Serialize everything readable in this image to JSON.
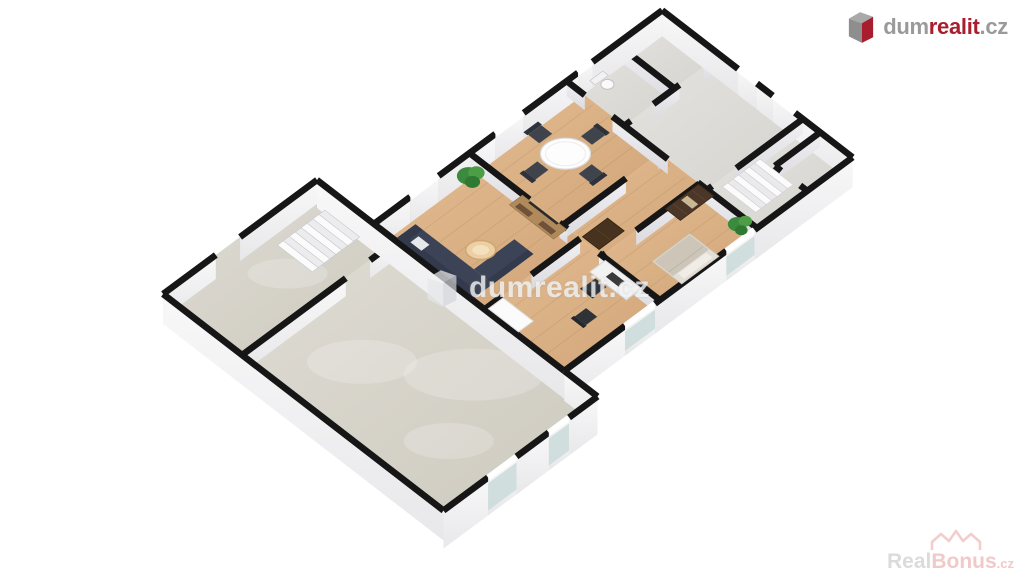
{
  "logo": {
    "dum": "dum",
    "realit": "realit",
    "cz": ".cz"
  },
  "watermark_center": {
    "text": "dumrealit.cz"
  },
  "watermark_bottom": {
    "real": "Real",
    "bonus": "Bonus",
    "cz": ".cz"
  },
  "colors": {
    "background": "#ffffff",
    "wall_line": "#161616",
    "floor_wood": "#d9af83",
    "floor_concrete": "#d5d2c9",
    "floor_tile": "#dedcd7",
    "sofa_navy": "#3c4356",
    "chair_dark": "#3e434c",
    "plant_green": "#3c8a3e",
    "wardrobe_brown": "#4b3627",
    "tv_unit_wood": "#b18a5b",
    "glass": "#ccdcdc",
    "logo_gray": "#9a9a9a",
    "logo_red": "#a81e2e",
    "watermark_light": "#f0f2f4",
    "realbonus_gray": "#d9d9d9",
    "realbonus_pink": "#f1c5c5"
  },
  "floorplan": {
    "type": "3d-isometric-floor-plan",
    "rooms": [
      {
        "name": "garage",
        "floor": "concrete",
        "furniture": []
      },
      {
        "name": "staircase-room",
        "floor": "concrete",
        "furniture": [
          "staircase"
        ]
      },
      {
        "name": "living-room",
        "floor": "wood",
        "furniture": [
          "corner-sofa",
          "coffee-table",
          "tv-wall-unit",
          "plant"
        ]
      },
      {
        "name": "dining-room",
        "floor": "wood",
        "furniture": [
          "round-table",
          "four-chairs"
        ]
      },
      {
        "name": "hallway",
        "floor": "wood",
        "furniture": [
          "cabinet"
        ]
      },
      {
        "name": "bedroom",
        "floor": "wood",
        "furniture": [
          "double-bed",
          "wardrobe-with-mirror",
          "plant"
        ]
      },
      {
        "name": "office",
        "floor": "wood",
        "furniture": [
          "desk",
          "two-office-chairs",
          "white-cabinet"
        ]
      },
      {
        "name": "wc",
        "floor": "tile",
        "furniture": [
          "toilet"
        ]
      },
      {
        "name": "entry",
        "floor": "tile",
        "furniture": []
      },
      {
        "name": "storage",
        "floor": "tile",
        "furniture": []
      },
      {
        "name": "upper-landing",
        "floor": "tile",
        "furniture": [
          "staircase",
          "closet"
        ]
      }
    ]
  }
}
